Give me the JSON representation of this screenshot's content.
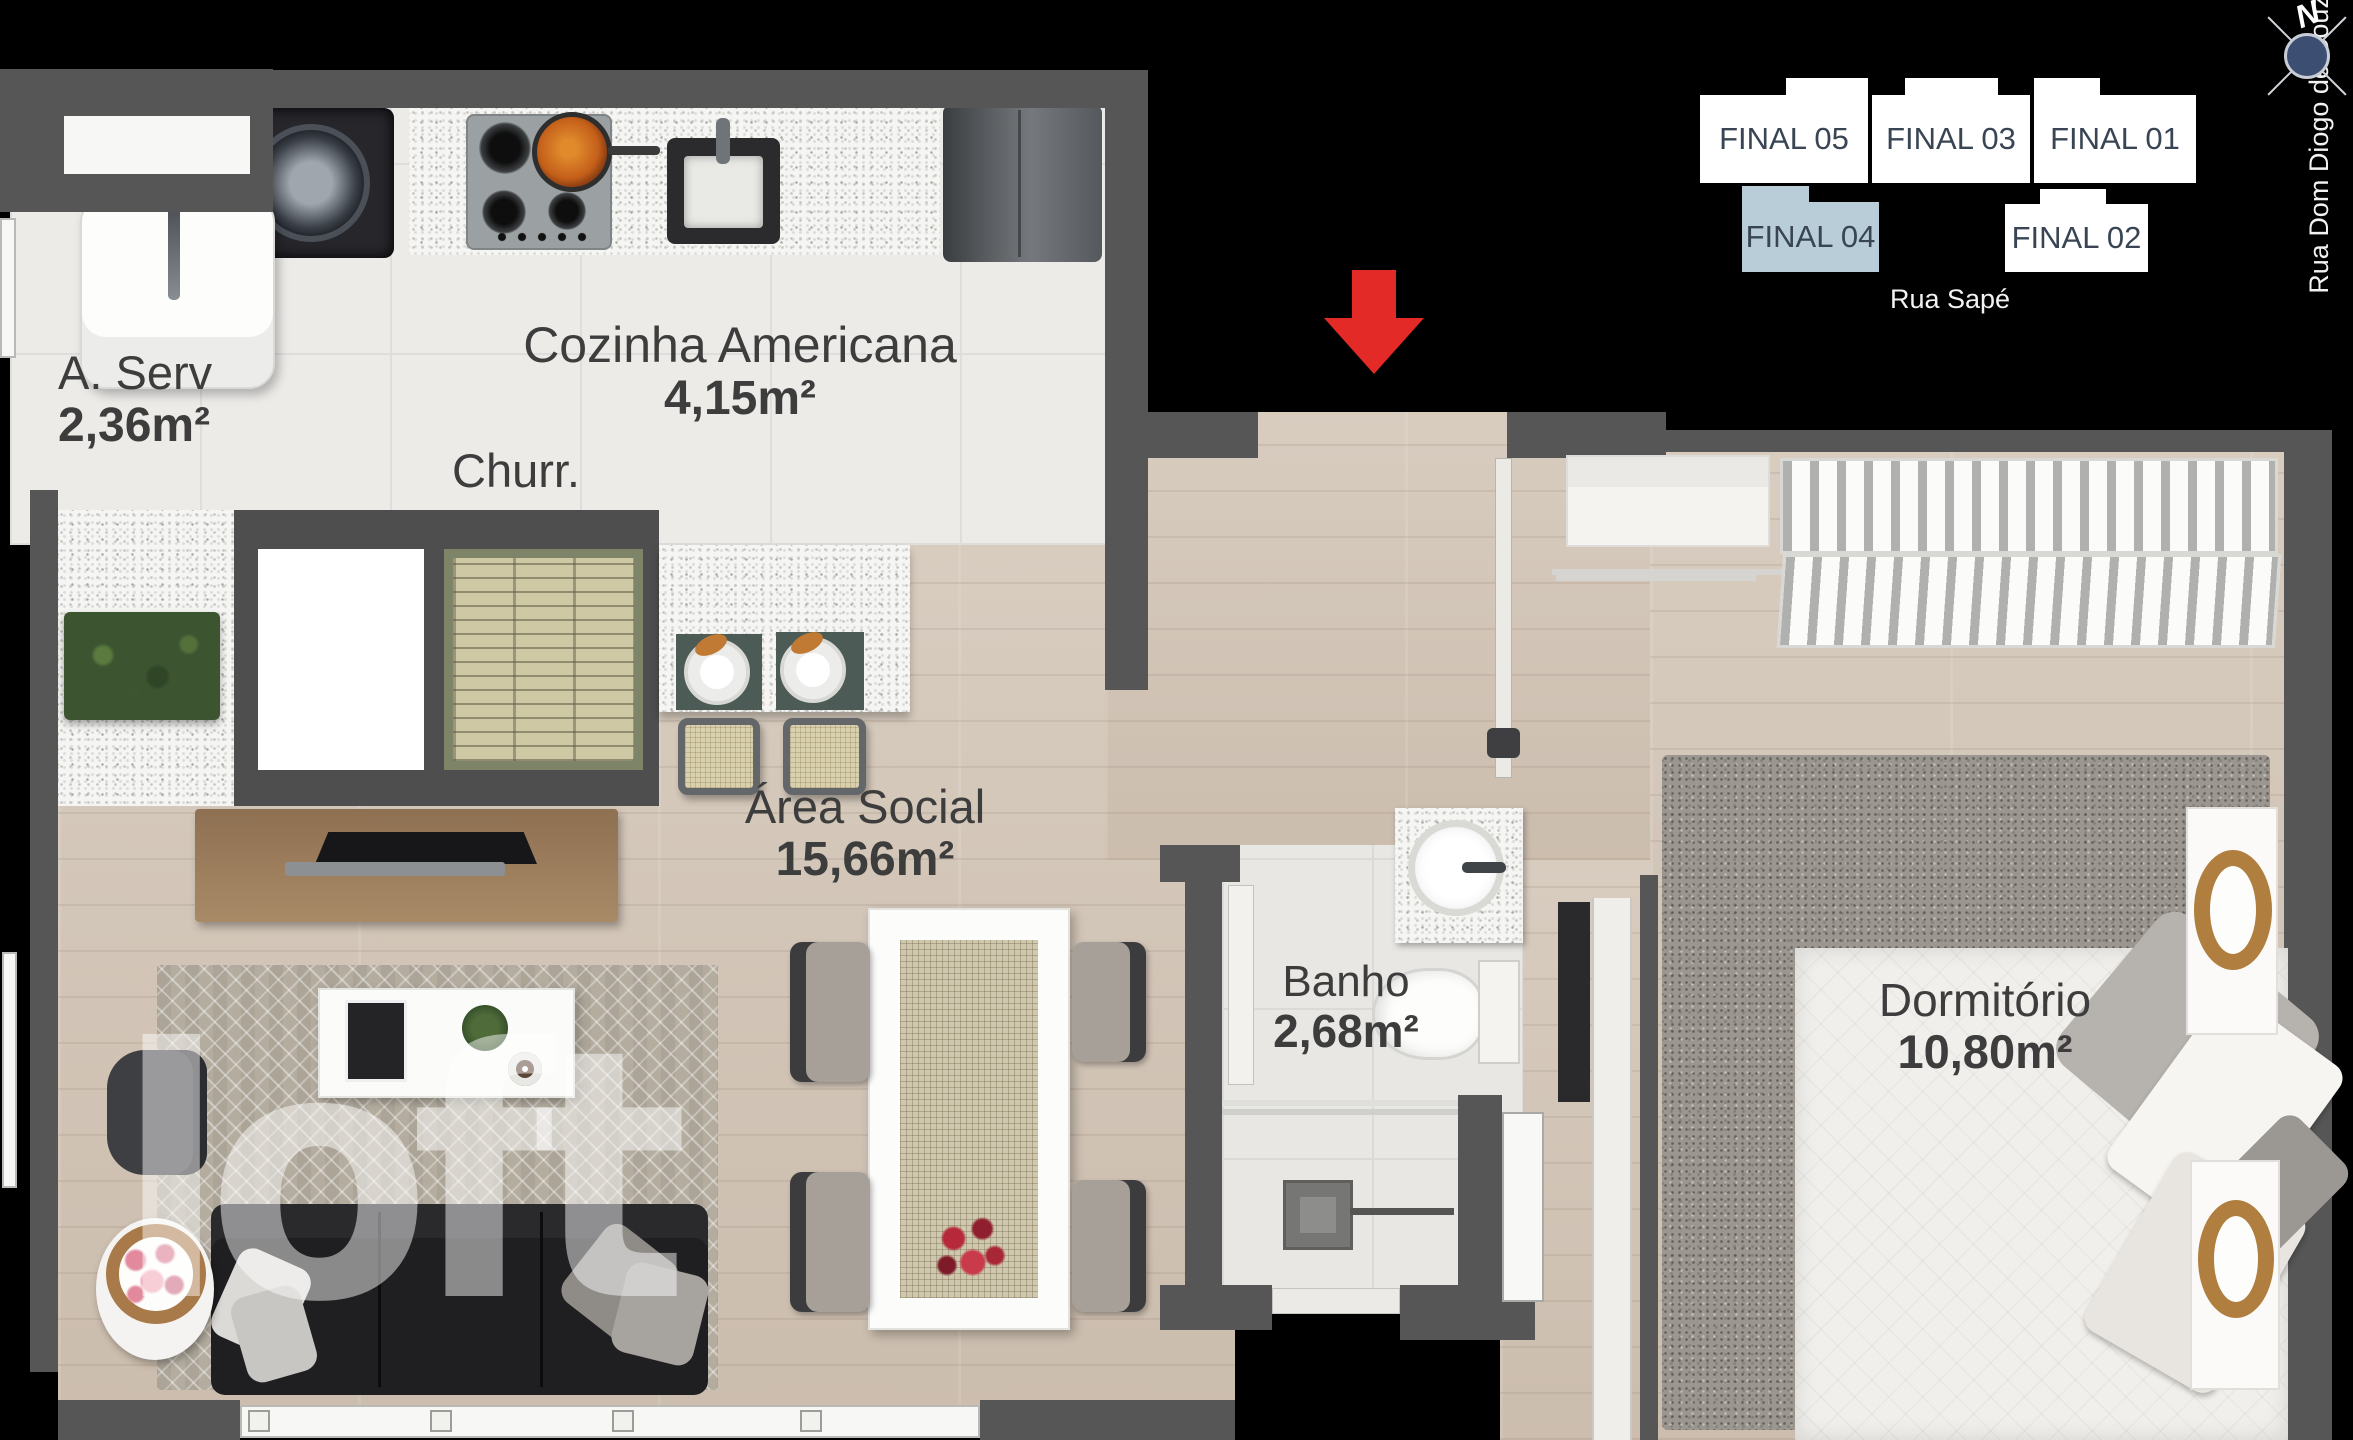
{
  "plan": {
    "rooms": [
      {
        "name": "A. Serv",
        "area": "2,36m²"
      },
      {
        "name": "Cozinha Americana",
        "area": "4,15m²"
      },
      {
        "name": "Churr.",
        "area": ""
      },
      {
        "name": "Área Social",
        "area": "15,66m²"
      },
      {
        "name": "Banho",
        "area": "2,68m²"
      },
      {
        "name": "Dormitório",
        "area": "10,80m²"
      }
    ],
    "entrance_arrow": {
      "direction": "down"
    }
  },
  "sitemap": {
    "units": [
      {
        "label": "FINAL 05",
        "highlighted": false
      },
      {
        "label": "FINAL 03",
        "highlighted": false
      },
      {
        "label": "FINAL 01",
        "highlighted": false
      },
      {
        "label": "FINAL 04",
        "highlighted": true
      },
      {
        "label": "FINAL 02",
        "highlighted": false
      }
    ],
    "street_bottom": "Rua Sapé",
    "street_right": "Rua Dom Diogo de Souza"
  },
  "compass": {
    "label": "N"
  },
  "watermark": {
    "text": "loft"
  },
  "colors": {
    "background": "#000000",
    "wall": "#565656",
    "arrow": "#e32a26",
    "unit_highlight": "#b9cdd9"
  }
}
